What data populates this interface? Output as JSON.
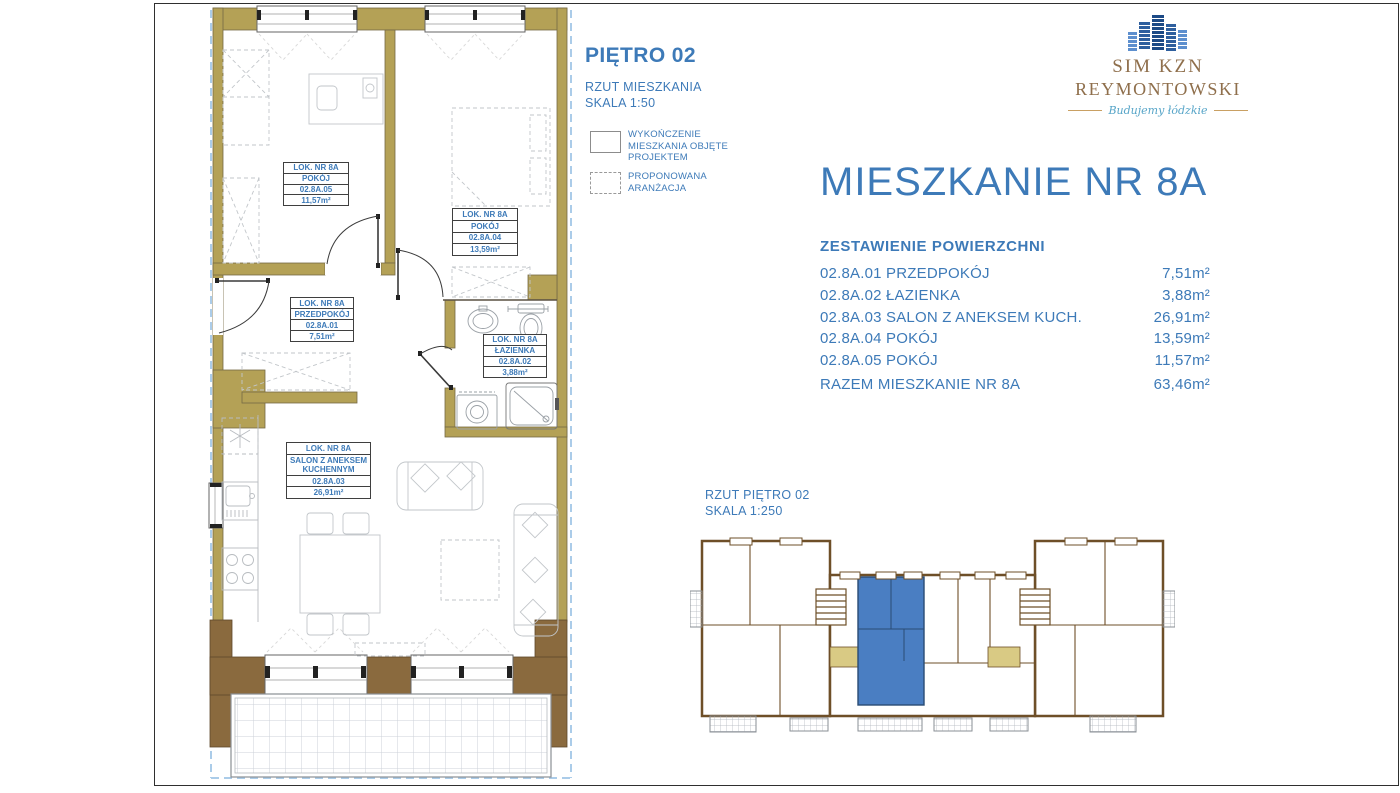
{
  "document": {
    "floor_title": "PIĘTRO 02",
    "plan_type": "RZUT MIESZKANIA",
    "plan_scale": "SKALA 1:50",
    "legend": {
      "finished_label": "WYKOŃCZENIE\nMIESZKANIA OBJĘTE\nPROJEKTEM",
      "proposed_label": "PROPONOWANA\nARANŻACJA"
    },
    "site_plan_title": "RZUT PIĘTRO 02",
    "site_plan_scale": "SKALA 1:250"
  },
  "logo": {
    "name_line1": "SIM KZN",
    "name_line2": "REYMONTOWSKI",
    "tagline": "Budujemy łódzkie"
  },
  "apartment": {
    "title": "MIESZKANIE NR 8A",
    "summary_header": "ZESTAWIENIE POWIERZCHNI",
    "rooms": [
      {
        "label": "02.8A.01 PRZEDPOKÓJ",
        "area": "7,51m²"
      },
      {
        "label": "02.8A.02 ŁAZIENKA",
        "area": "3,88m²"
      },
      {
        "label": "02.8A.03 SALON Z ANEKSEM KUCH.",
        "area": "26,91m²"
      },
      {
        "label": "02.8A.04 POKÓJ",
        "area": "13,59m²"
      },
      {
        "label": "02.8A.05 POKÓJ",
        "area": "11,57m²"
      },
      {
        "label": "RAZEM MIESZKANIE NR 8A",
        "area": "63,46m²"
      }
    ]
  },
  "room_labels": [
    {
      "cells": [
        "LOK. NR 8A",
        "POKÓJ",
        "02.8A.05",
        "11,57m²"
      ]
    },
    {
      "cells": [
        "LOK. NR 8A",
        "POKÓJ",
        "02.8A.04",
        "13,59m²"
      ]
    },
    {
      "cells": [
        "LOK. NR 8A",
        "PRZEDPOKÓJ",
        "02.8A.01",
        "7,51m²"
      ]
    },
    {
      "cells": [
        "LOK. NR 8A",
        "ŁAZIENKA",
        "02.8A.02",
        "3,88m²"
      ]
    },
    {
      "cells": [
        "LOK. NR 8A",
        "SALON Z ANEKSEM\nKUCHENNYM",
        "02.8A.03",
        "26,91m²"
      ]
    }
  ],
  "colors": {
    "accent_blue": "#3d7ab8",
    "wall_gold": "#b4a156",
    "wall_dark": "#8a6a3e",
    "highlighted_unit_blue": "#4a7ec2",
    "logo_gold": "#8f6f4c",
    "tagline_blue": "#57a5c8"
  }
}
